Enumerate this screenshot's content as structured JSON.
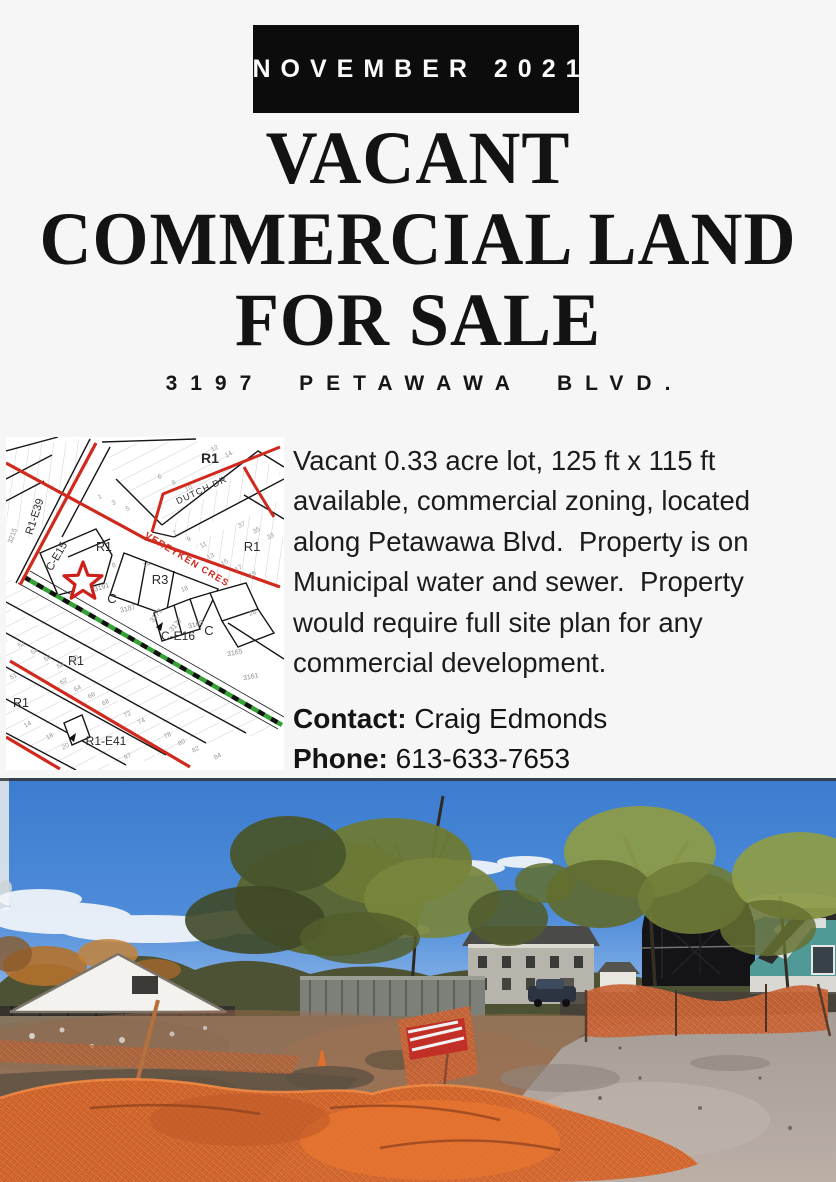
{
  "banner": {
    "label": "NOVEMBER 2021"
  },
  "title": {
    "lines": [
      "VACANT",
      "COMMERCIAL LAND",
      "FOR SALE"
    ]
  },
  "subtitle": "3197 PETAWAWA BLVD.",
  "description_lines": [
    "Vacant 0.33 acre lot, 125 ft x 115 ft",
    "available, commercial zoning, located",
    "along Petawawa Blvd.  Property is on",
    "Municipal water and sewer.  Property",
    "would require full site plan for any",
    "commercial development."
  ],
  "description_full": "Vacant 0.33 acre lot, 125 ft x 115 ft available, commercial zoning, located along Petawawa Blvd.  Property is on Municipal water and sewer.  Property would require full site plan for any commercial development.",
  "contact": {
    "label": "Contact:",
    "name": "Craig Edmonds",
    "phone_label": "Phone:",
    "phone": "613-633-7653"
  },
  "map": {
    "zones": {
      "r1_top": "R1",
      "r1_mid": "R1",
      "r1_right": "R1",
      "r3": "R3",
      "c_mid": "C",
      "c_right": "C",
      "r1_low": "R1",
      "r1_low2": "R1"
    },
    "streets": {
      "dutch": "DUTCH DR",
      "vereyken": "VEREYKEN CRES"
    },
    "exceptions": {
      "e39": "R1-E39",
      "e15": "C-E15",
      "e16": "C-E16",
      "e41": "R1-E41"
    },
    "parcel_numbers": [
      "3191",
      "3187",
      "3179",
      "3177",
      "3169",
      "3165",
      "3161",
      "3215"
    ],
    "lot_numbers": [
      "12",
      "14",
      "6",
      "8",
      "10",
      "1",
      "3",
      "5",
      "7",
      "9",
      "11",
      "37",
      "35",
      "33",
      "13",
      "15",
      "17",
      "19",
      "18",
      "14",
      "8",
      "24",
      "52",
      "54",
      "56",
      "58",
      "60",
      "62",
      "64",
      "66",
      "68",
      "72",
      "74",
      "78",
      "80",
      "82",
      "84",
      "97",
      "51",
      "14",
      "18",
      "20"
    ],
    "colors": {
      "road_red": "#cf2a1d",
      "railway_green": "#35a035",
      "star_red": "#cc2018",
      "parcel_black": "#1a1a1a",
      "lot_grey": "#9a9a9a"
    }
  },
  "photo": {
    "alt": "Vacant dirt lot surrounded by orange construction mesh fencing, autumn trees, houses and blue sky",
    "colors": {
      "sky_top": "#3c7ccf",
      "sky_horizon": "#9cc0ec",
      "foliage_green": "#6d7c3a",
      "foliage_dark": "#42492c",
      "autumn_orange": "#b4712e",
      "dirt_brown": "#8b7660",
      "dirt_red": "#9a6a4d",
      "asphalt_grey": "#aca49c",
      "fence_orange": "#c96134",
      "fence_bright": "#d86327",
      "barn_dark": "#141417",
      "teal_house": "#4f9a97",
      "white_house": "#f4f2ee",
      "sign_red": "#c22f26"
    }
  }
}
